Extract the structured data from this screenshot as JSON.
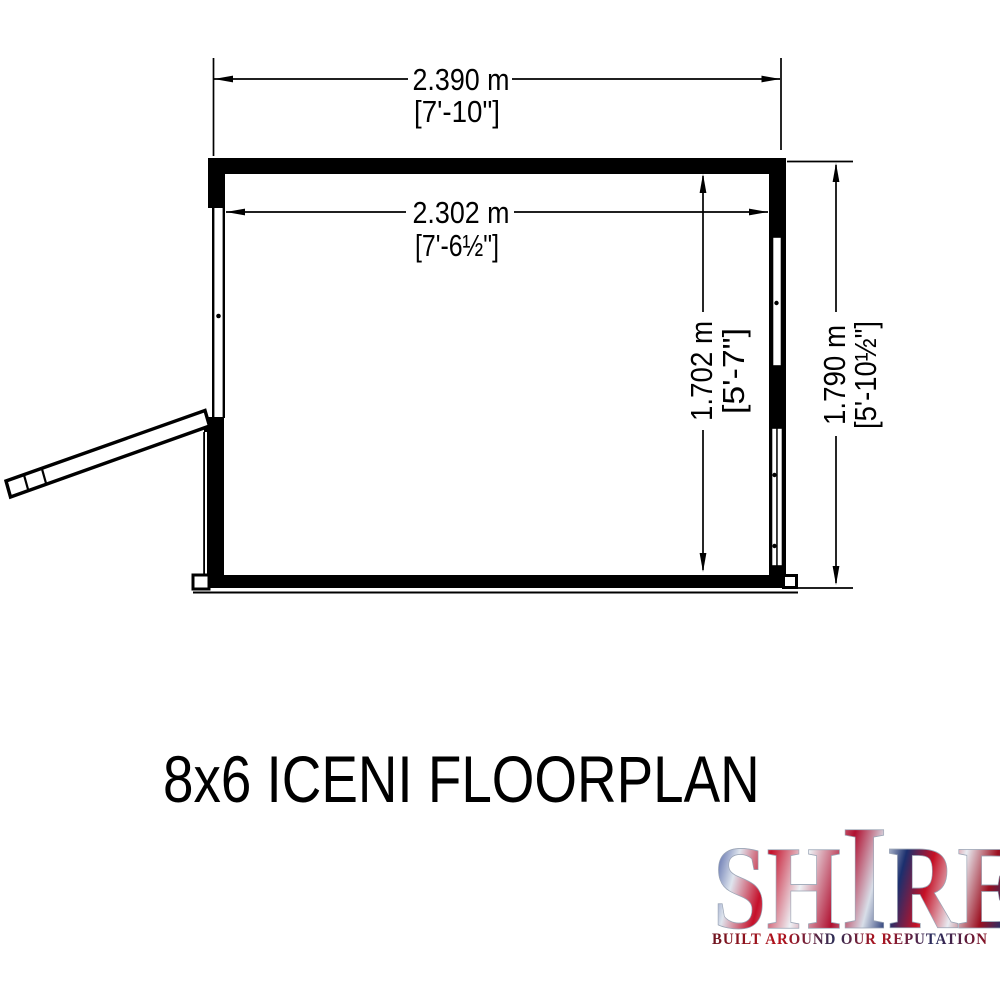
{
  "title": "8x6 ICENI FLOORPLAN",
  "dimensions": {
    "width_outer": {
      "metric": "2.390 m",
      "imperial": "[7'-10\"]"
    },
    "width_inner": {
      "metric": "2.302 m",
      "imperial": "[7'-6½\"]"
    },
    "depth_inner": {
      "metric": "1.702 m",
      "imperial": "[5'-7\"]"
    },
    "depth_outer": {
      "metric": "1.790 m",
      "imperial": "[5'-10½\"]"
    }
  },
  "logo": {
    "brand": "SHIRE",
    "brand_parts": {
      "left": "SH",
      "tall": "I",
      "right": "RE"
    },
    "tagline": "BUILT AROUND OUR REPUTATION",
    "colors": {
      "flag_red": "#b5121b",
      "flag_blue": "#1b2f6e",
      "flag_white": "#e8ecf2"
    }
  },
  "drawing": {
    "ink": "#000000",
    "background": "#ffffff"
  }
}
